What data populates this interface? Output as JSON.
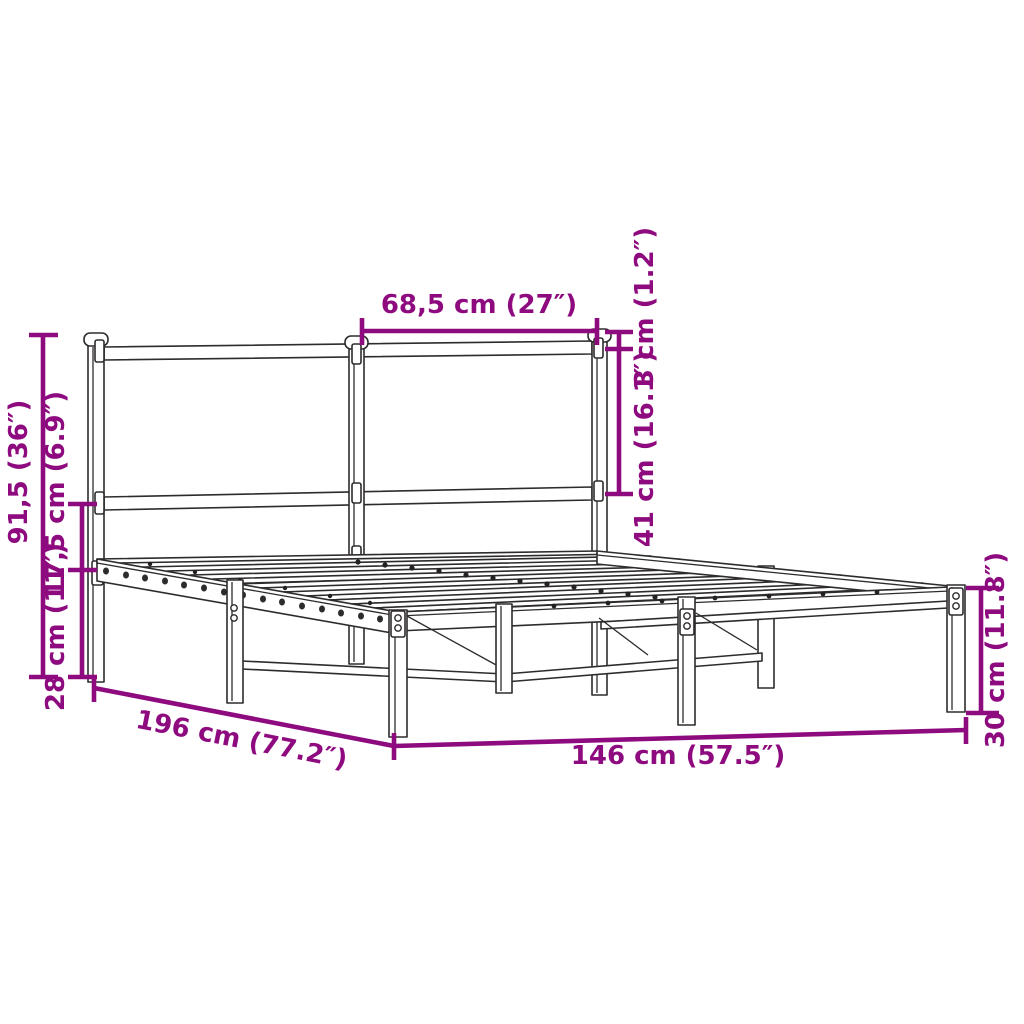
{
  "meta": {
    "type": "product dimension diagram",
    "subject": "metal bed frame with headboard",
    "background_color": "#ffffff"
  },
  "style": {
    "dimension_color": "#8E0A7F",
    "line_art_color": "#2e2b2c"
  },
  "labels": {
    "headboard_section_width": "68,5 cm (27″)",
    "headboard_cap_offset": "3 cm (1.2″)",
    "headboard_panel_height": "41 cm (16.1″)",
    "headboard_height": "91,5 (36″)",
    "rail_to_headboard_gap": "17,5 cm (6.9″)",
    "under_bed_clearance": "28 cm (11″)",
    "bed_length": "196 cm (77.2″)",
    "bed_width": "146 cm (57.5″)",
    "platform_height": "30 cm (11.8″)"
  }
}
